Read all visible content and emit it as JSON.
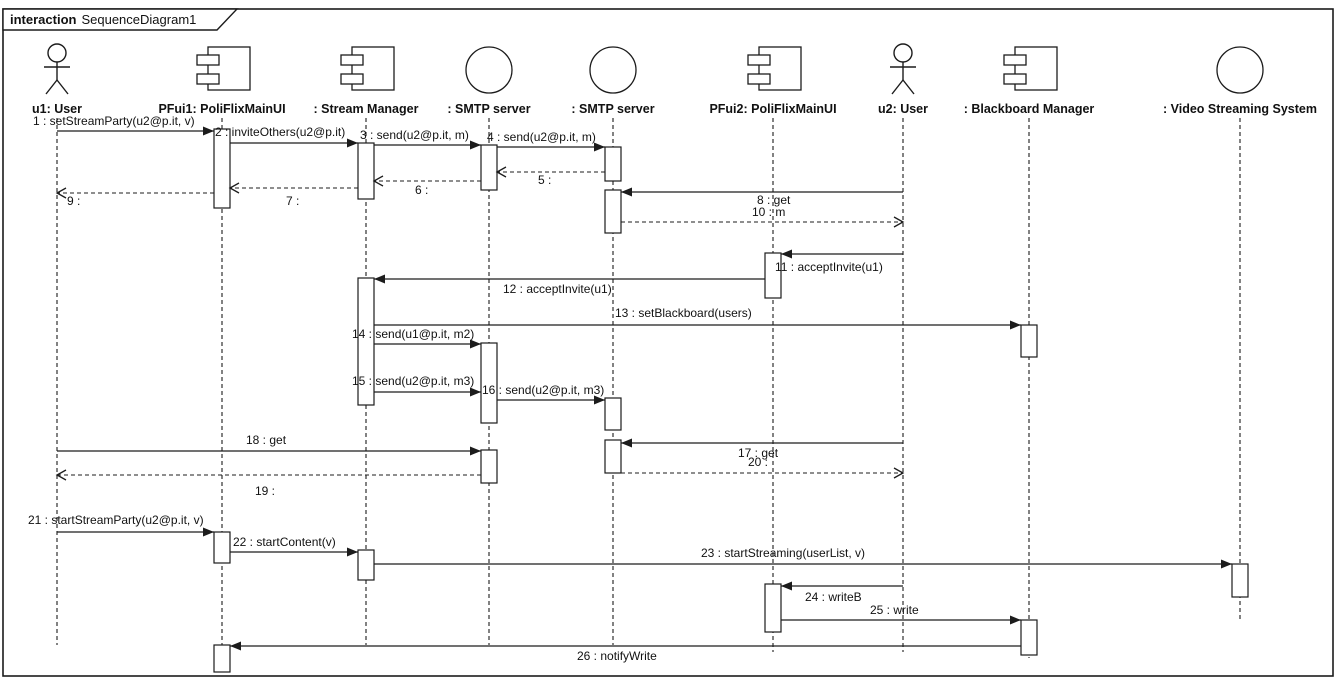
{
  "frame": {
    "tab_keyword": "interaction",
    "tab_title": "SequenceDiagram1"
  },
  "colors": {
    "stroke": "#1c1c1c",
    "background": "#ffffff",
    "activation_fill": "#ffffff",
    "text": "#111111"
  },
  "diagram": {
    "width": 1340,
    "height": 692,
    "lifelines": [
      {
        "id": "u1",
        "label": "u1: User",
        "kind": "actor",
        "x": 57,
        "line_end": 645
      },
      {
        "id": "pfui1",
        "label": "PFui1: PoliFlixMainUI",
        "kind": "component",
        "x": 222,
        "line_end": 645
      },
      {
        "id": "sm",
        "label": ": Stream Manager",
        "kind": "component",
        "x": 366,
        "line_end": 645
      },
      {
        "id": "smtp1",
        "label": ": SMTP server",
        "kind": "interface",
        "x": 489,
        "line_end": 645
      },
      {
        "id": "smtp2",
        "label": ": SMTP server",
        "kind": "interface",
        "x": 613,
        "line_end": 645
      },
      {
        "id": "pfui2",
        "label": "PFui2: PoliFlixMainUI",
        "kind": "component",
        "x": 773,
        "line_end": 652
      },
      {
        "id": "u2",
        "label": "u2: User",
        "kind": "actor",
        "x": 903,
        "line_end": 652
      },
      {
        "id": "bb",
        "label": ": Blackboard Manager",
        "kind": "component",
        "x": 1029,
        "line_end": 658
      },
      {
        "id": "vss",
        "label": ": Video Streaming System",
        "kind": "interface",
        "x": 1240,
        "line_end": 622
      }
    ],
    "activations": [
      {
        "lifeline": "pfui1",
        "y1": 129,
        "y2": 208
      },
      {
        "lifeline": "sm",
        "y1": 143,
        "y2": 199
      },
      {
        "lifeline": "smtp1",
        "y1": 145,
        "y2": 190
      },
      {
        "lifeline": "smtp2",
        "y1": 147,
        "y2": 181
      },
      {
        "lifeline": "smtp2",
        "y1": 190,
        "y2": 233
      },
      {
        "lifeline": "pfui2",
        "y1": 253,
        "y2": 298
      },
      {
        "lifeline": "sm",
        "y1": 278,
        "y2": 405
      },
      {
        "lifeline": "bb",
        "y1": 325,
        "y2": 357
      },
      {
        "lifeline": "smtp1",
        "y1": 343,
        "y2": 423
      },
      {
        "lifeline": "smtp2",
        "y1": 398,
        "y2": 430
      },
      {
        "lifeline": "smtp2",
        "y1": 440,
        "y2": 473
      },
      {
        "lifeline": "smtp1",
        "y1": 450,
        "y2": 483
      },
      {
        "lifeline": "pfui1",
        "y1": 532,
        "y2": 563
      },
      {
        "lifeline": "sm",
        "y1": 550,
        "y2": 580
      },
      {
        "lifeline": "vss",
        "y1": 564,
        "y2": 597
      },
      {
        "lifeline": "pfui2",
        "y1": 584,
        "y2": 632
      },
      {
        "lifeline": "bb",
        "y1": 620,
        "y2": 655
      },
      {
        "lifeline": "pfui1",
        "y1": 645,
        "y2": 672
      }
    ],
    "messages": [
      {
        "num": 1,
        "text": "1 : setStreamParty(u2@p.it, v)",
        "from": "u1",
        "to": "pfui1",
        "kind": "sync",
        "y": 131,
        "x1": 57,
        "x2": 214,
        "lx": 33,
        "ly": 125
      },
      {
        "num": 2,
        "text": "2 : inviteOthers(u2@p.it)",
        "from": "pfui1",
        "to": "sm",
        "kind": "sync",
        "y": 143,
        "x1": 230,
        "x2": 358,
        "lx": 215,
        "ly": 136
      },
      {
        "num": 3,
        "text": "3 : send(u2@p.it, m)",
        "from": "sm",
        "to": "smtp1",
        "kind": "sync",
        "y": 145,
        "x1": 374,
        "x2": 481,
        "lx": 360,
        "ly": 139
      },
      {
        "num": 4,
        "text": "4 : send(u2@p.it, m)",
        "from": "smtp1",
        "to": "smtp2",
        "kind": "sync",
        "y": 147,
        "x1": 497,
        "x2": 605,
        "lx": 487,
        "ly": 141
      },
      {
        "num": 5,
        "text": "5 :",
        "from": "smtp2",
        "to": "smtp1",
        "kind": "reply",
        "y": 172,
        "x1": 605,
        "x2": 497,
        "lx": 538,
        "ly": 184
      },
      {
        "num": 6,
        "text": "6 :",
        "from": "smtp1",
        "to": "sm",
        "kind": "reply",
        "y": 181,
        "x1": 481,
        "x2": 374,
        "lx": 415,
        "ly": 194
      },
      {
        "num": 7,
        "text": "7 :",
        "from": "sm",
        "to": "pfui1",
        "kind": "reply",
        "y": 188,
        "x1": 358,
        "x2": 230,
        "lx": 286,
        "ly": 205
      },
      {
        "num": 8,
        "text": "8 : get",
        "from": "u2",
        "to": "smtp2",
        "kind": "sync",
        "y": 192,
        "x1": 903,
        "x2": 621,
        "lx": 757,
        "ly": 204
      },
      {
        "num": 9,
        "text": "9 :",
        "from": "pfui1",
        "to": "u1",
        "kind": "reply",
        "y": 193,
        "x1": 214,
        "x2": 57,
        "lx": 67,
        "ly": 205
      },
      {
        "num": 10,
        "text": "10 : m",
        "from": "smtp2",
        "to": "u2",
        "kind": "reply",
        "y": 222,
        "x1": 621,
        "x2": 903,
        "lx": 752,
        "ly": 216
      },
      {
        "num": 11,
        "text": "11 : acceptInvite(u1)",
        "from": "u2",
        "to": "pfui2",
        "kind": "sync",
        "y": 254,
        "x1": 903,
        "x2": 781,
        "lx": 775,
        "ly": 271
      },
      {
        "num": 12,
        "text": "12 : acceptInvite(u1)",
        "from": "pfui2",
        "to": "sm",
        "kind": "sync",
        "y": 279,
        "x1": 765,
        "x2": 374,
        "lx": 503,
        "ly": 293
      },
      {
        "num": 13,
        "text": "13 : setBlackboard(users)",
        "from": "sm",
        "to": "bb",
        "kind": "sync",
        "y": 325,
        "x1": 374,
        "x2": 1021,
        "lx": 615,
        "ly": 317
      },
      {
        "num": 14,
        "text": "14 : send(u1@p.it, m2)",
        "from": "sm",
        "to": "smtp1",
        "kind": "sync",
        "y": 344,
        "x1": 374,
        "x2": 481,
        "lx": 352,
        "ly": 338
      },
      {
        "num": 15,
        "text": "15 : send(u2@p.it, m3)",
        "from": "sm",
        "to": "smtp1",
        "kind": "sync",
        "y": 392,
        "x1": 374,
        "x2": 481,
        "lx": 352,
        "ly": 385
      },
      {
        "num": 16,
        "text": "16 : send(u2@p.it, m3)",
        "from": "smtp1",
        "to": "smtp2",
        "kind": "sync",
        "y": 400,
        "x1": 497,
        "x2": 605,
        "lx": 482,
        "ly": 394
      },
      {
        "num": 17,
        "text": "17 : get",
        "from": "u2",
        "to": "smtp2",
        "kind": "sync",
        "y": 443,
        "x1": 903,
        "x2": 621,
        "lx": 738,
        "ly": 457
      },
      {
        "num": 18,
        "text": "18 : get",
        "from": "u1",
        "to": "smtp1",
        "kind": "sync",
        "y": 451,
        "x1": 57,
        "x2": 481,
        "lx": 246,
        "ly": 444
      },
      {
        "num": 19,
        "text": "19 :",
        "from": "smtp1",
        "to": "u1",
        "kind": "reply",
        "y": 475,
        "x1": 481,
        "x2": 57,
        "lx": 255,
        "ly": 495
      },
      {
        "num": 20,
        "text": "20 :",
        "from": "smtp2",
        "to": "u2",
        "kind": "reply",
        "y": 473,
        "x1": 621,
        "x2": 903,
        "lx": 748,
        "ly": 466
      },
      {
        "num": 21,
        "text": "21 : startStreamParty(u2@p.it, v)",
        "from": "u1",
        "to": "pfui1",
        "kind": "sync",
        "y": 532,
        "x1": 57,
        "x2": 214,
        "lx": 28,
        "ly": 524
      },
      {
        "num": 22,
        "text": "22 : startContent(v)",
        "from": "pfui1",
        "to": "sm",
        "kind": "sync",
        "y": 552,
        "x1": 230,
        "x2": 358,
        "lx": 233,
        "ly": 546
      },
      {
        "num": 23,
        "text": "23 : startStreaming(userList, v)",
        "from": "sm",
        "to": "vss",
        "kind": "sync",
        "y": 564,
        "x1": 374,
        "x2": 1232,
        "lx": 701,
        "ly": 557
      },
      {
        "num": 24,
        "text": "24 : writeB",
        "from": "u2",
        "to": "pfui2",
        "kind": "sync",
        "y": 586,
        "x1": 903,
        "x2": 781,
        "lx": 805,
        "ly": 601
      },
      {
        "num": 25,
        "text": "25 : write",
        "from": "pfui2",
        "to": "bb",
        "kind": "sync",
        "y": 620,
        "x1": 781,
        "x2": 1021,
        "lx": 870,
        "ly": 614
      },
      {
        "num": 26,
        "text": "26 : notifyWrite",
        "from": "bb",
        "to": "pfui1",
        "kind": "sync",
        "y": 646,
        "x1": 1021,
        "x2": 230,
        "lx": 577,
        "ly": 660
      }
    ]
  }
}
